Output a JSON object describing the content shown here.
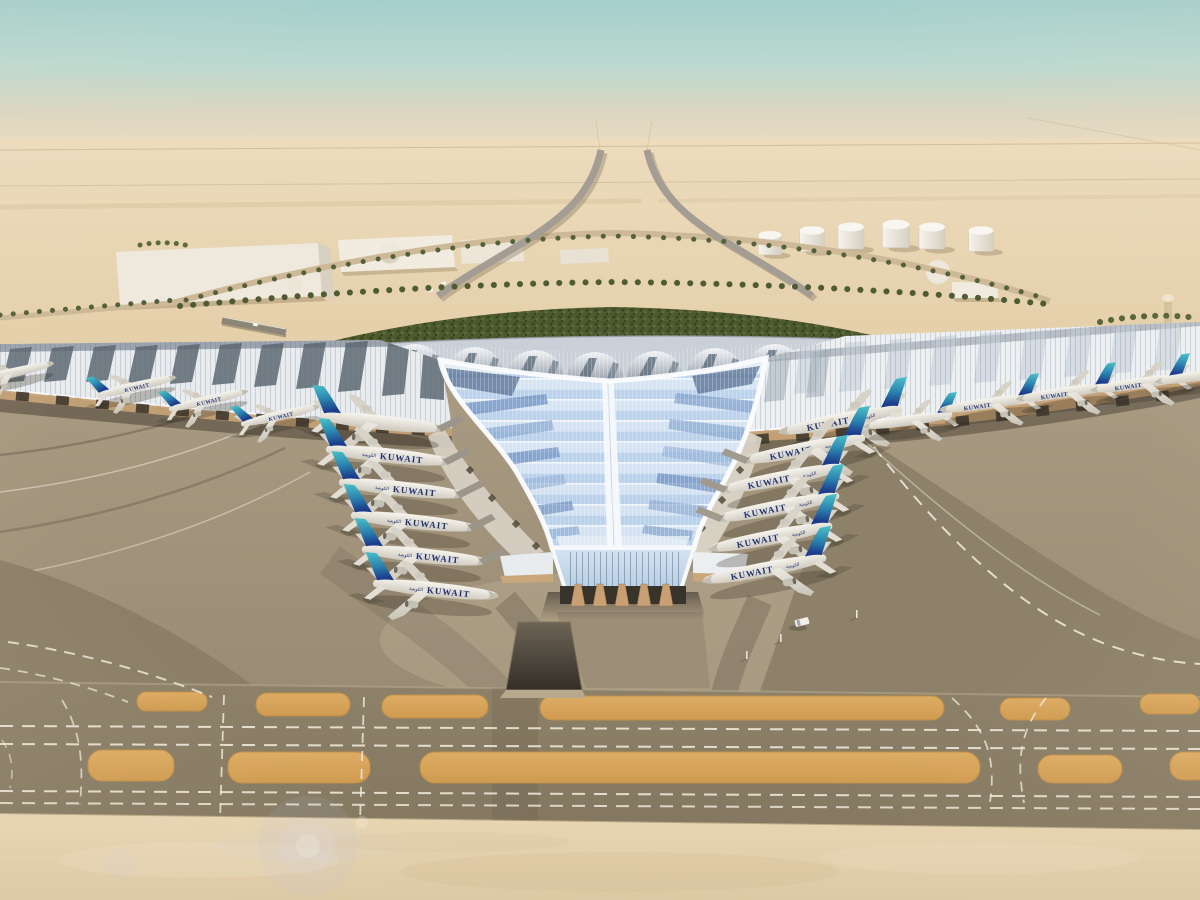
{
  "scene": {
    "type": "aerial-architectural-rendering",
    "subject": "Y-shaped desert airport terminal with swooping glazed roof and aircraft at gates",
    "aircraft_livery_label": "KUWAIT",
    "aircraft_livery_label_arabic": "الكويتية",
    "sky": {
      "top_color": "#a4cfcc",
      "horizon_color": "#e9dcc2"
    },
    "desert_color": "#e6d2ac",
    "aircraft": {
      "west_wing_count": 4,
      "left_pier_count": 6,
      "right_pier_count": 6,
      "east_wing_count": 5,
      "tail_teal": "#3fb7c0",
      "tail_blue": "#1c3c8c",
      "fuselage_color": "#f2efe8"
    },
    "terminal": {
      "roof_color": "#eceff1",
      "valley_glass_color": "#c2d6ec",
      "fascia_color": "#c29f74",
      "vault_color": "#7c8894"
    },
    "airside": {
      "apron_color": "#a2947c",
      "taxiway_color": "#887c64",
      "island_color": "#d8a55c",
      "marking_color": "#f2ede0",
      "marking_style": "white dashed centerlines"
    },
    "landside": {
      "fuel_tank_count": 6,
      "warehouse_count": 4,
      "dome_count": 2,
      "garden_color": "#4d5a30",
      "palm_lined_loop_road": true
    },
    "vehicle": {
      "type": "service-van",
      "color": "#f2f0ea"
    }
  }
}
